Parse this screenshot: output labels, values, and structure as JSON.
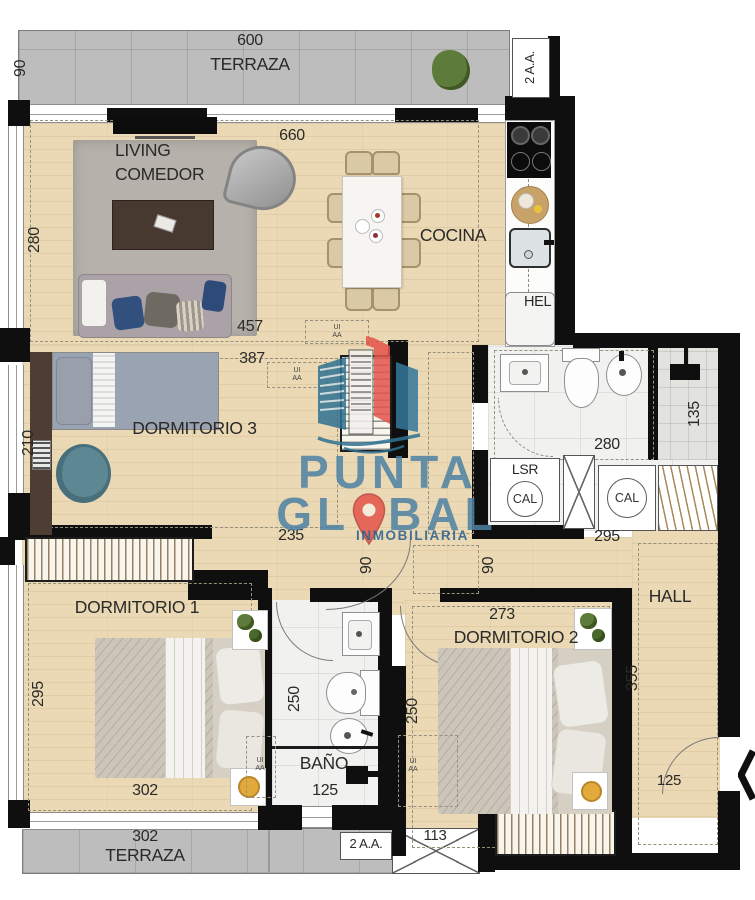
{
  "brand": {
    "line1": "PUNTA",
    "line2_left": "GL",
    "line2_right": "BAL",
    "subtitle": "INMOBILIARIA"
  },
  "terraza_top": {
    "label": "TERRAZA",
    "width": "600",
    "depth": "90",
    "ac": "2 A.A."
  },
  "living": {
    "label_line1": "LIVING",
    "label_line2": "COMEDOR",
    "width": "660",
    "depth": "280",
    "dim_bottom": "457"
  },
  "cocina": {
    "label": "COCINA",
    "fridge": "HEL"
  },
  "dorm3": {
    "label": "DORMITORIO 3",
    "width": "387",
    "depth": "210",
    "dim_bottom": "235"
  },
  "suite_bath": {
    "width": "280",
    "shower_depth": "135"
  },
  "utility": {
    "lsr": "LSR",
    "cal": "CAL",
    "cal2": "CAL",
    "hall_top_width": "295"
  },
  "corridor": {
    "door1_width": "90",
    "door2_width": "90"
  },
  "dorm1": {
    "label": "DORMITORIO 1",
    "depth": "295",
    "width": "302"
  },
  "bano": {
    "label": "BAÑO",
    "depth": "250",
    "width": "125"
  },
  "dorm2": {
    "label": "DORMITORIO 2",
    "width": "273",
    "depth": "250"
  },
  "hall": {
    "label": "HALL",
    "depth": "355",
    "door_width": "125"
  },
  "terraza_bottom": {
    "width": "302",
    "label": "TERRAZA",
    "ac": "2 A.A.",
    "void_width": "113"
  },
  "ducts": {
    "ui": "UI",
    "aa": "AA"
  },
  "colors": {
    "brand_blue": "#4d80a4",
    "brand_dark_blue": "#27608f",
    "pin_red": "#e4544a",
    "wall_black": "#0f0f0f"
  }
}
